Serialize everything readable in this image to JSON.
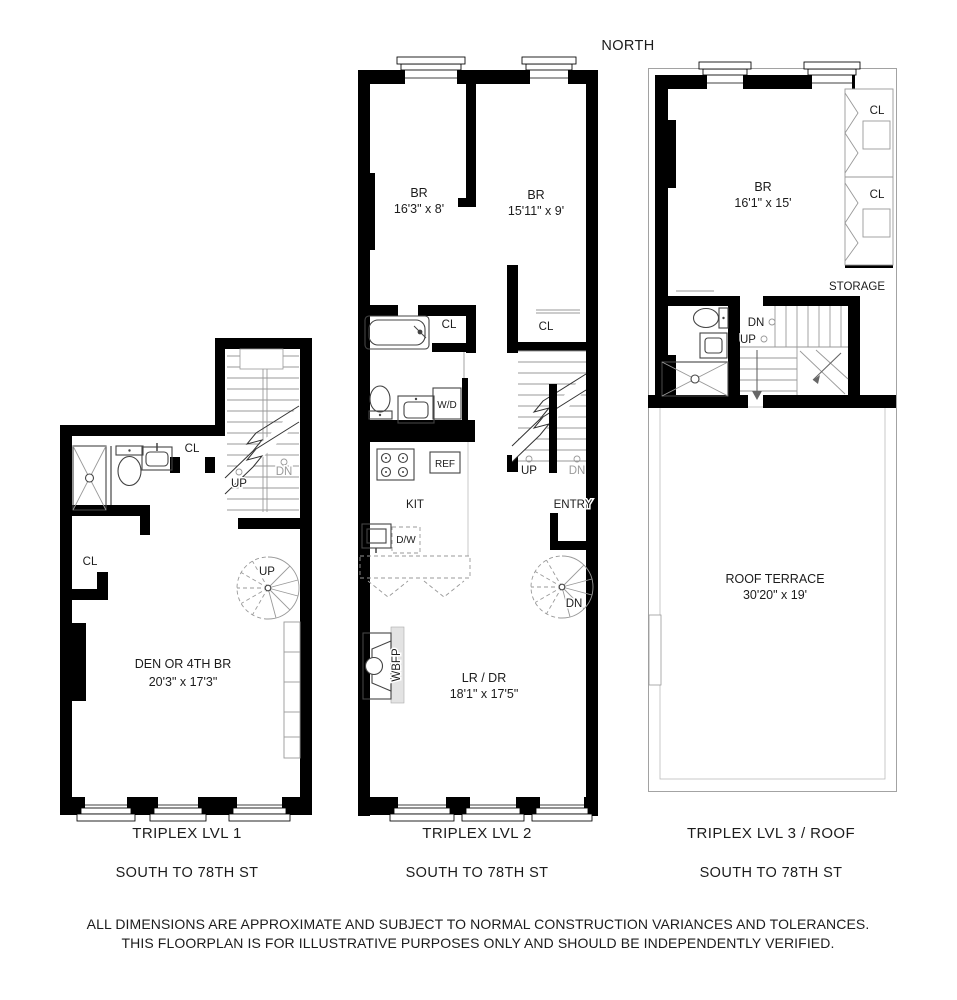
{
  "page": {
    "north": "NORTH",
    "disclaimer_line1": "ALL DIMENSIONS ARE APPROXIMATE AND SUBJECT TO NORMAL CONSTRUCTION VARIANCES AND TOLERANCES.",
    "disclaimer_line2": "THIS FLOORPLAN IS FOR ILLUSTRATIVE PURPOSES ONLY AND SHOULD BE INDEPENDENTLY VERIFIED."
  },
  "plans": {
    "lvl1": {
      "title": "TRIPLEX LVL 1",
      "street": "SOUTH TO 78TH ST",
      "rooms": {
        "den_name": "DEN OR 4TH BR",
        "den_dims": "20'3\" x 17'3\""
      },
      "labels": {
        "closet_bath": "CL",
        "closet_hall": "CL",
        "stair_up": "UP",
        "stair_dn": "DN",
        "spiral_up": "UP"
      }
    },
    "lvl2": {
      "title": "TRIPLEX LVL 2",
      "street": "SOUTH TO 78TH ST",
      "rooms": {
        "br1_name": "BR",
        "br1_dims": "16'3\" x 8'",
        "br2_name": "BR",
        "br2_dims": "15'11\" x 9'",
        "lrdr_name": "LR / DR",
        "lrdr_dims": "18'1\" x 17'5\"",
        "kitchen": "KIT",
        "entry": "ENTRY"
      },
      "labels": {
        "closet_bath": "CL",
        "closet_entry": "CL",
        "washer_dryer": "W/D",
        "refrigerator": "REF",
        "dishwasher": "D/W",
        "fireplace": "WBFP",
        "stair_up": "UP",
        "stair_dn": "DN",
        "spiral_dn": "DN"
      }
    },
    "lvl3": {
      "title": "TRIPLEX LVL 3 / ROOF",
      "street": "SOUTH TO 78TH ST",
      "rooms": {
        "br_name": "BR",
        "br_dims": "16'1\" x 15'",
        "terrace_name": "ROOF TERRACE",
        "terrace_dims": "30'20\" x 19'",
        "storage": "STORAGE"
      },
      "labels": {
        "closet_top": "CL",
        "closet_bottom": "CL",
        "stair_dn": "DN",
        "stair_up": "UP"
      }
    }
  }
}
